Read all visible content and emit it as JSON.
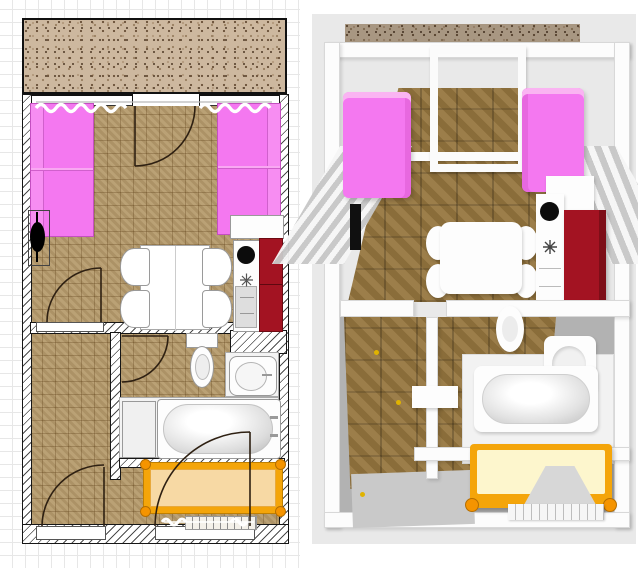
{
  "app": {
    "title": "Apartment floor plan — 2D plan and 3D overhead views"
  },
  "views": {
    "plan2d": {
      "label": "2D floor plan view"
    },
    "view3d": {
      "label": "3D overhead render view"
    }
  },
  "colors": {
    "plan_grid": "#e7e7e7",
    "floor_tile": "#b59a6b",
    "balcony_base": "#cdb89f",
    "wall_line": "#161616",
    "sofa": "#f478f0",
    "cabinet_red": "#a31322",
    "fixture": "#fdfdfd",
    "fixture_edge": "#999999",
    "bed_frame": "#f4a50a",
    "bed_mattress": "#f7d9a4",
    "bed_mattress_3d": "#fdf6cd",
    "door_stroke": "#2e2012",
    "bg3d": "#e9e9e9",
    "floor3d_wood": "#96763f",
    "concrete": "#b2b2b2",
    "concrete_light": "#c9c9c9",
    "handle_yellow": "#e0b300"
  },
  "objects": {
    "balcony": "Balcony with gravel floor",
    "living_room": "Living room",
    "hallway": "Hallway",
    "bathroom": "Bathroom",
    "bedroom_area": "Sleeping area",
    "sofa_left": "Pink sofa (left)",
    "sofa_right": "Pink sofa (right)",
    "tv": "Television",
    "dining_table": "Dining table",
    "chair": "Dining chair",
    "kitchen_counter": "Kitchen counter with sink",
    "kitchen_sink": "Kitchen sink",
    "cooktop": "Cooktop burner",
    "appliance": "Under-counter appliance",
    "red_cabinet": "Tall red cabinet",
    "toilet": "Toilet",
    "washbasin": "Washbasin",
    "bathtub": "Bathtub",
    "bath_cabinet": "Bathroom cabinet",
    "bed": "Bed with gold frame",
    "radiator_window": "Window with radiator",
    "balcony_door": "Balcony door",
    "interior_door": "Interior door",
    "entrance_door": "Entrance door",
    "curtains": "Window curtains"
  }
}
